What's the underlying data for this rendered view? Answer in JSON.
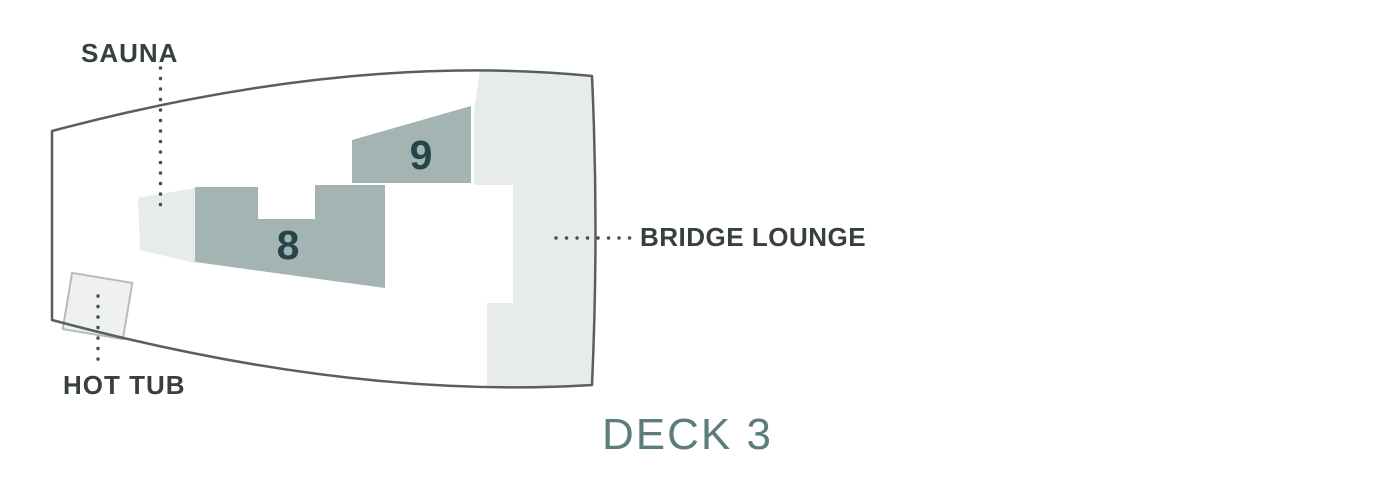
{
  "deck_plan": {
    "title": "DECK 3",
    "areas": [
      {
        "number": "8"
      },
      {
        "number": "9"
      }
    ],
    "callouts": {
      "sauna": "SAUNA",
      "hot_tub": "HOT TUB",
      "bridge_lounge": "BRIDGE LOUNGE"
    },
    "colors": {
      "hull_outline": "#56615f",
      "deck_fill": "#ffffff",
      "lounge_fill": "#e7ebeb",
      "cabin_fill": "#a4b4b3",
      "sauna_fill": "#e7ebea",
      "hot_tub_fill": "#eef1f0",
      "hot_tub_border": "#b5bcbb",
      "label_text": "#373f3f",
      "number_text": "#26454a",
      "title_text": "#5d7c7c",
      "leader_dots": "#454f4f"
    }
  }
}
